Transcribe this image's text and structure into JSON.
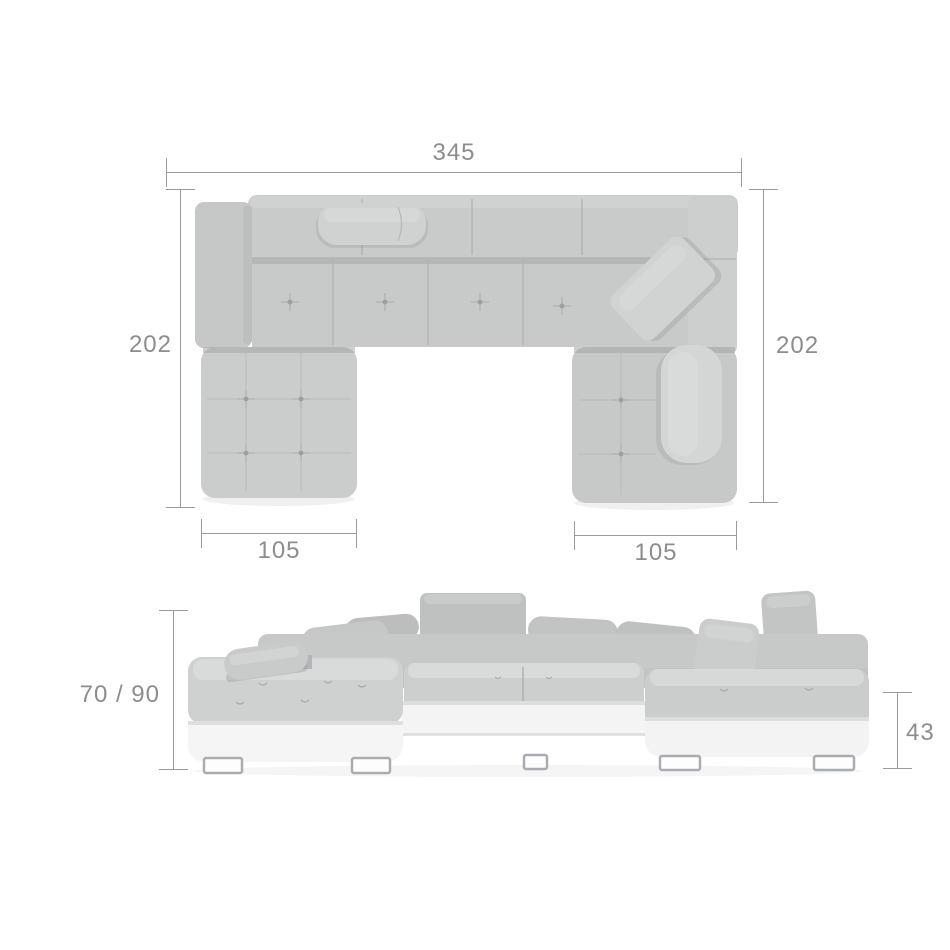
{
  "dimensions": {
    "top_view": {
      "total_width": "345",
      "left_depth": "202",
      "right_depth": "202",
      "left_chaise_width": "105",
      "right_chaise_width": "105"
    },
    "front_view": {
      "height_range": "70 / 90",
      "base_height": "43"
    }
  },
  "colors": {
    "fabric_gray": "#c9cbca",
    "fabric_light": "#d8dad9",
    "base_white": "#f3f4f3",
    "chrome_leg": "#a9adb1",
    "dimension_line": "#9b9b9b",
    "dimension_text": "#8d8d8d",
    "background": "#ffffff"
  }
}
